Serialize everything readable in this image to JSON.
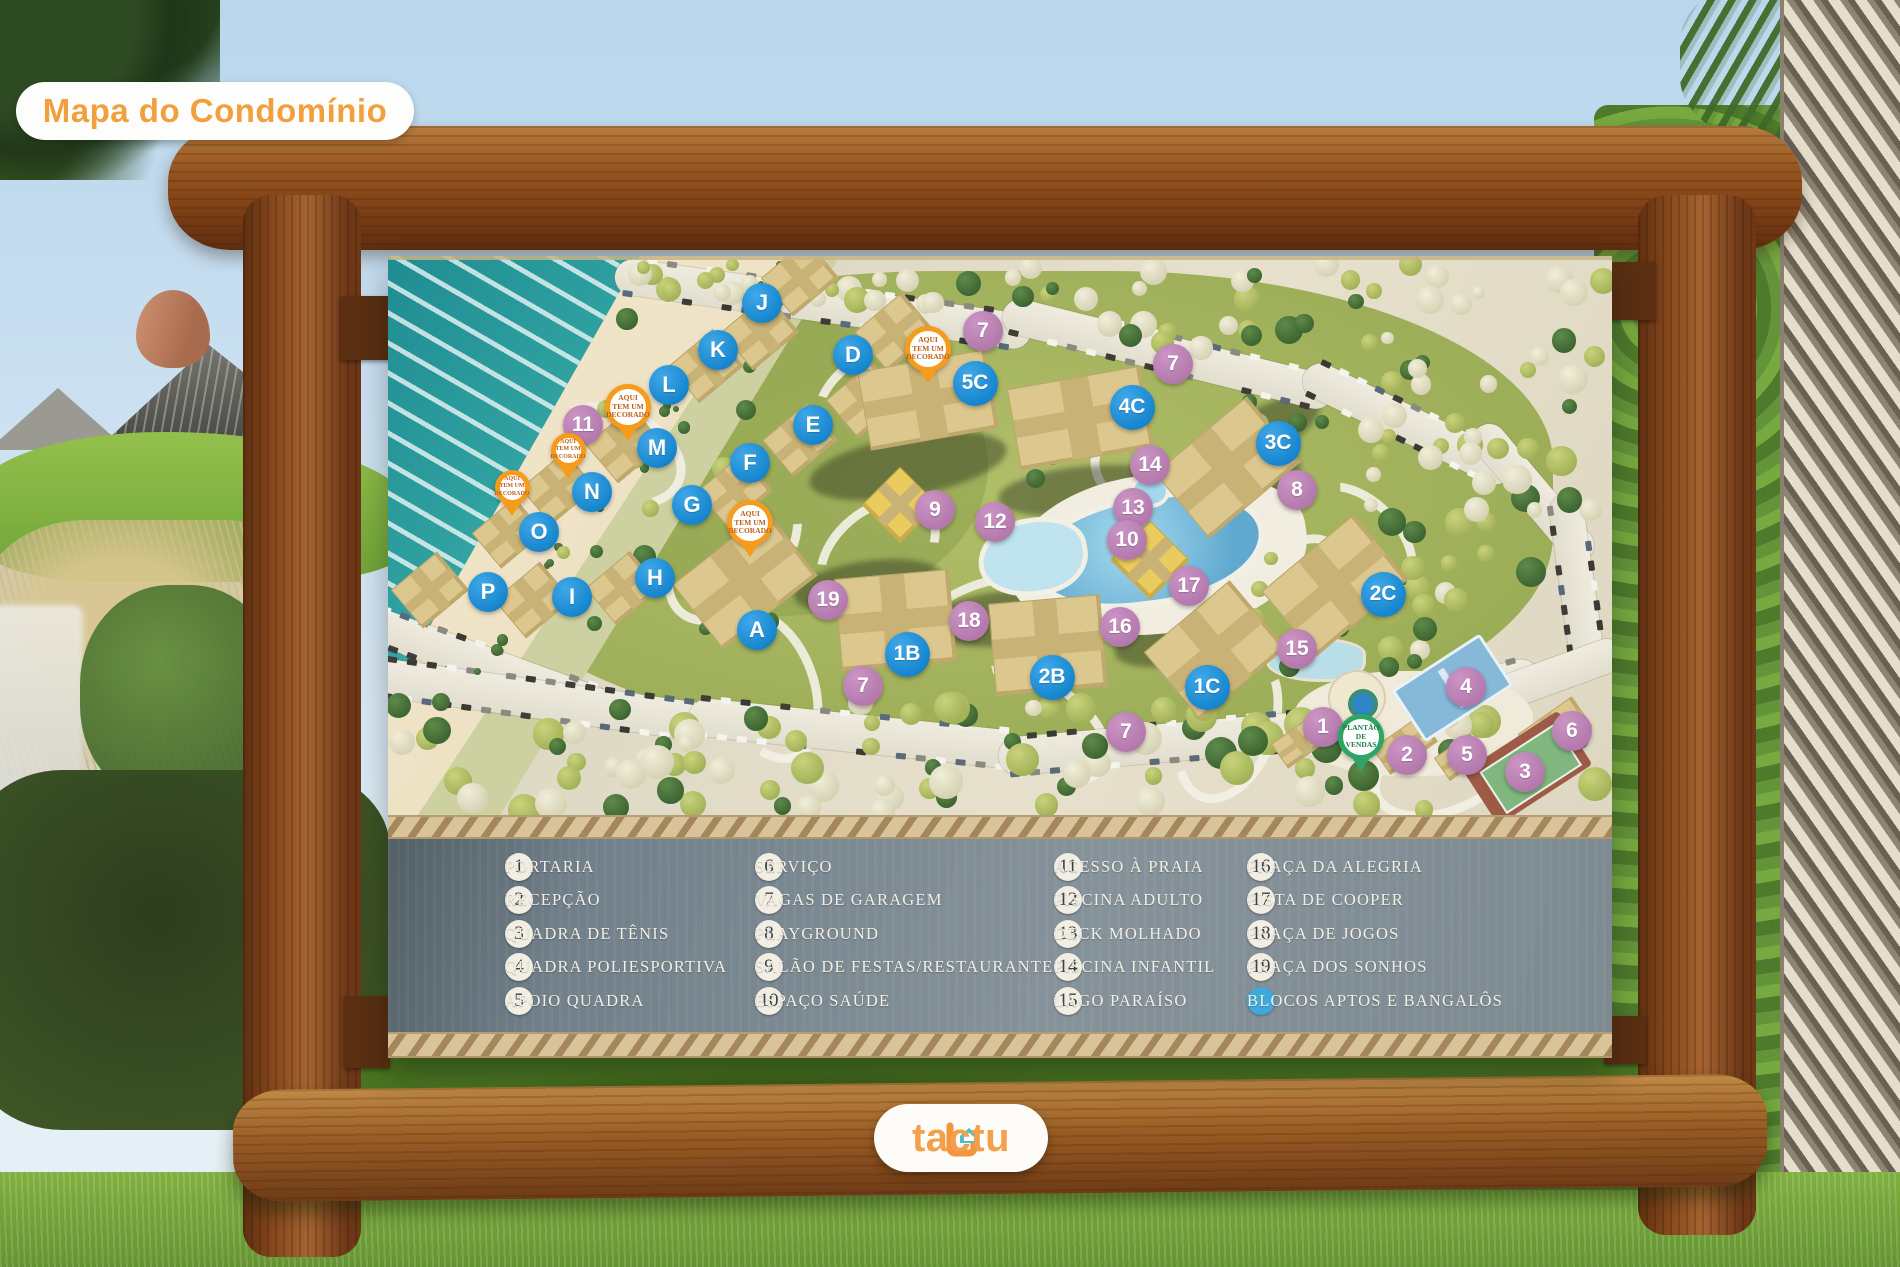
{
  "badge": {
    "label": "Mapa do Condomínio"
  },
  "logo": {
    "text": "tactu"
  },
  "legend": {
    "columns": [
      {
        "items": [
          {
            "num": "1",
            "label": "PORTARIA"
          },
          {
            "num": "2",
            "label": "RECEPÇÃO"
          },
          {
            "num": "3",
            "label": "QUADRA DE TÊNIS"
          },
          {
            "num": "4",
            "label": "QUADRA POLIESPORTIVA"
          },
          {
            "num": "5",
            "label": "APOIO QUADRA"
          }
        ]
      },
      {
        "items": [
          {
            "num": "6",
            "label": "SERVIÇO"
          },
          {
            "num": "7",
            "label": "VAGAS DE GARAGEM"
          },
          {
            "num": "8",
            "label": "PLAYGROUND"
          },
          {
            "num": "9",
            "label": "SALÃO DE FESTAS/RESTAURANTE"
          },
          {
            "num": "10",
            "label": "ESPAÇO SAÚDE"
          }
        ]
      },
      {
        "items": [
          {
            "num": "11",
            "label": "ACESSO À PRAIA"
          },
          {
            "num": "12",
            "label": "PISCINA ADULTO"
          },
          {
            "num": "13",
            "label": "DECK MOLHADO"
          },
          {
            "num": "14",
            "label": "PISCINA INFANTIL"
          },
          {
            "num": "15",
            "label": "LAGO PARAÍSO"
          }
        ]
      },
      {
        "items": [
          {
            "num": "16",
            "label": "PRAÇA DA ALEGRIA"
          },
          {
            "num": "17",
            "label": "PISTA DE COOPER"
          },
          {
            "num": "18",
            "label": "PRAÇA DE JOGOS"
          },
          {
            "num": "19",
            "label": "PRAÇA DOS SONHOS"
          },
          {
            "num": "",
            "dot": true,
            "label": "BLOCOS APTOS E BANGALÔS"
          }
        ]
      }
    ]
  },
  "map": {
    "letter_markers": [
      {
        "label": "J",
        "x": 762,
        "y": 303
      },
      {
        "label": "K",
        "x": 718,
        "y": 350
      },
      {
        "label": "L",
        "x": 669,
        "y": 385
      },
      {
        "label": "M",
        "x": 657,
        "y": 448
      },
      {
        "label": "N",
        "x": 592,
        "y": 492
      },
      {
        "label": "O",
        "x": 539,
        "y": 532
      },
      {
        "label": "P",
        "x": 488,
        "y": 592
      },
      {
        "label": "I",
        "x": 572,
        "y": 597
      },
      {
        "label": "H",
        "x": 655,
        "y": 578
      },
      {
        "label": "A",
        "x": 757,
        "y": 630
      },
      {
        "label": "D",
        "x": 853,
        "y": 355
      },
      {
        "label": "E",
        "x": 813,
        "y": 425
      },
      {
        "label": "F",
        "x": 750,
        "y": 463
      },
      {
        "label": "G",
        "x": 692,
        "y": 505
      }
    ],
    "building_labels": [
      {
        "label": "5C",
        "x": 975,
        "y": 383
      },
      {
        "label": "4C",
        "x": 1132,
        "y": 407
      },
      {
        "label": "3C",
        "x": 1278,
        "y": 443
      },
      {
        "label": "2C",
        "x": 1383,
        "y": 594
      },
      {
        "label": "1C",
        "x": 1207,
        "y": 687
      },
      {
        "label": "2B",
        "x": 1052,
        "y": 677
      },
      {
        "label": "1B",
        "x": 907,
        "y": 654
      }
    ],
    "number_markers": [
      {
        "label": "7",
        "x": 983,
        "y": 331
      },
      {
        "label": "7",
        "x": 1173,
        "y": 364
      },
      {
        "label": "14",
        "x": 1150,
        "y": 465
      },
      {
        "label": "8",
        "x": 1297,
        "y": 490
      },
      {
        "label": "9",
        "x": 935,
        "y": 510
      },
      {
        "label": "12",
        "x": 995,
        "y": 522
      },
      {
        "label": "13",
        "x": 1133,
        "y": 508
      },
      {
        "label": "10",
        "x": 1127,
        "y": 540
      },
      {
        "label": "11",
        "x": 583,
        "y": 425
      },
      {
        "label": "17",
        "x": 1189,
        "y": 586
      },
      {
        "label": "16",
        "x": 1120,
        "y": 627
      },
      {
        "label": "15",
        "x": 1297,
        "y": 649
      },
      {
        "label": "19",
        "x": 828,
        "y": 600
      },
      {
        "label": "18",
        "x": 969,
        "y": 621
      },
      {
        "label": "7",
        "x": 863,
        "y": 686
      },
      {
        "label": "7",
        "x": 1126,
        "y": 732
      },
      {
        "label": "1",
        "x": 1323,
        "y": 727
      },
      {
        "label": "2",
        "x": 1407,
        "y": 755
      },
      {
        "label": "4",
        "x": 1466,
        "y": 687
      },
      {
        "label": "5",
        "x": 1467,
        "y": 755
      },
      {
        "label": "3",
        "x": 1525,
        "y": 772
      },
      {
        "label": "6",
        "x": 1572,
        "y": 731
      }
    ],
    "decorado_pins": [
      {
        "lines": [
          "AQUI",
          "TEM UM",
          "DECORADO"
        ],
        "x": 628,
        "y": 407,
        "size": "large"
      },
      {
        "lines": [
          "AQUI",
          "TEM UM",
          "DECORADO"
        ],
        "x": 568,
        "y": 450,
        "size": "small"
      },
      {
        "lines": [
          "AQUI",
          "TEM UM",
          "DECORADO"
        ],
        "x": 512,
        "y": 487,
        "size": "small"
      },
      {
        "lines": [
          "AQUI",
          "TEM UM",
          "DECORADO"
        ],
        "x": 750,
        "y": 523,
        "size": "large"
      },
      {
        "lines": [
          "AQUI",
          "TEM UM",
          "DECORADO"
        ],
        "x": 928,
        "y": 349,
        "size": "large"
      }
    ],
    "sales_pin": {
      "lines": [
        "PLANTÃO",
        "DE",
        "VENDAS"
      ],
      "x": 1361,
      "y": 737
    }
  },
  "colors": {
    "accent_orange": "#f2a03e",
    "marker_blue": "#1b93d8",
    "marker_pink": "#b277ab",
    "pin_orange": "#f59c1d",
    "pin_green": "#2ea566",
    "legend_dot_blue": "#3fa9dc",
    "tactu_teal": "#4bbfbf"
  }
}
